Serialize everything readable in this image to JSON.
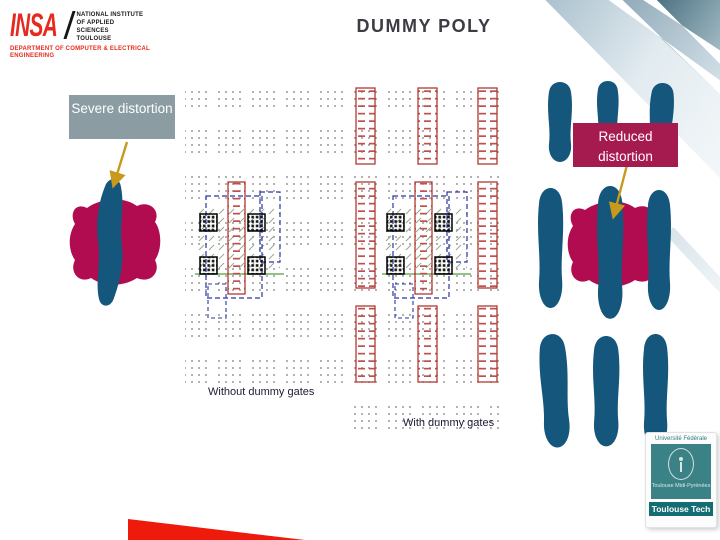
{
  "header": {
    "title": "DUMMY POLY"
  },
  "insa_logo": {
    "acronym": "INSA",
    "institute_lines": [
      "NATIONAL INSTITUTE",
      "OF APPLIED",
      "SCIENCES",
      "TOULOUSE"
    ],
    "department_lines": [
      "DEPARTMENT OF COMPUTER & ELECTRICAL",
      "ENGINEERING"
    ]
  },
  "callouts": {
    "severe": "Severe distortion",
    "reduced": "Reduced distortion"
  },
  "diagrams": {
    "left_caption": "Without dummy gates",
    "right_caption": "With dummy gates"
  },
  "footer_logo": {
    "line1": "Université Fédérale",
    "line2": "Toulouse Midi-Pyrénées",
    "brand": "Toulouse Tech"
  },
  "colors": {
    "insa_red": "#e62b1e",
    "title_gray": "#3c3c44",
    "severe_box_gray": "#8b9da3",
    "reduced_box_crimson": "#a51a4f",
    "blob_crimson": "#b10c50",
    "blob_blue": "#15567c",
    "arrow_gold": "#c9991c",
    "dummy_poly_red": "#b03a33",
    "active_region_navy": "#2a35a0",
    "gate_green_line": "#6fae5c",
    "bottom_wedge_red": "#ee1a0b",
    "corner_band_dark": "#4a6f7e",
    "toulouse_tech_teal": "#3b8287",
    "toulouse_tech_ribbon": "#156d74"
  }
}
